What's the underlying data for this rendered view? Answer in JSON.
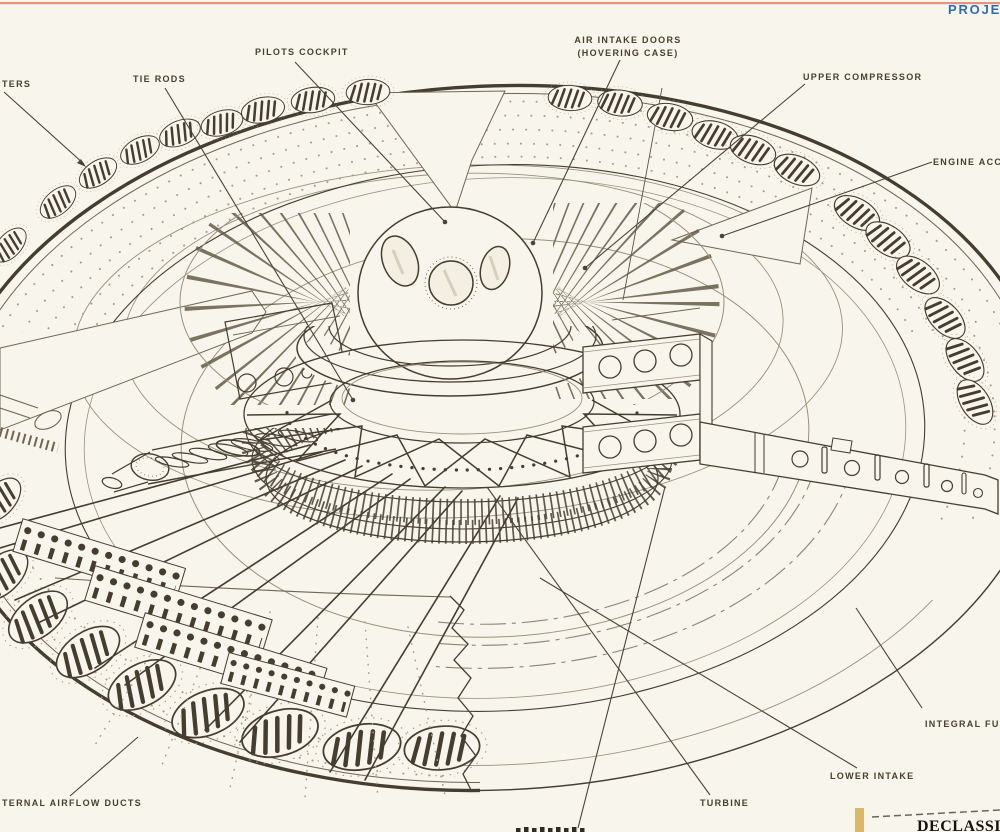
{
  "header": {
    "project_fragment": "PROJEC"
  },
  "callouts": {
    "shutters_fragment": "TERS",
    "tie_rods": "TIE RODS",
    "pilots_cockpit": "PILOTS COCKPIT",
    "air_intake_line1": "AIR INTAKE DOORS",
    "air_intake_line2": "(HOVERING CASE)",
    "upper_compressor": "UPPER COMPRESSOR",
    "engine_accessories_fragment": "ENGINE ACCE",
    "integral_fuel_fragment": "INTEGRAL FUEL",
    "lower_intake": "LOWER INTAKE",
    "turbine": "TURBINE",
    "airflow_ducts_fragment": "TERNAL AIRFLOW DUCTS"
  },
  "stamp": {
    "declassified_fragment": "DECLASSIFIE"
  },
  "colors": {
    "top_rule": "#e18a6f",
    "project_blue": "#2e6cb2",
    "paper": "#f8f5ed",
    "ink": "#453d2f"
  }
}
